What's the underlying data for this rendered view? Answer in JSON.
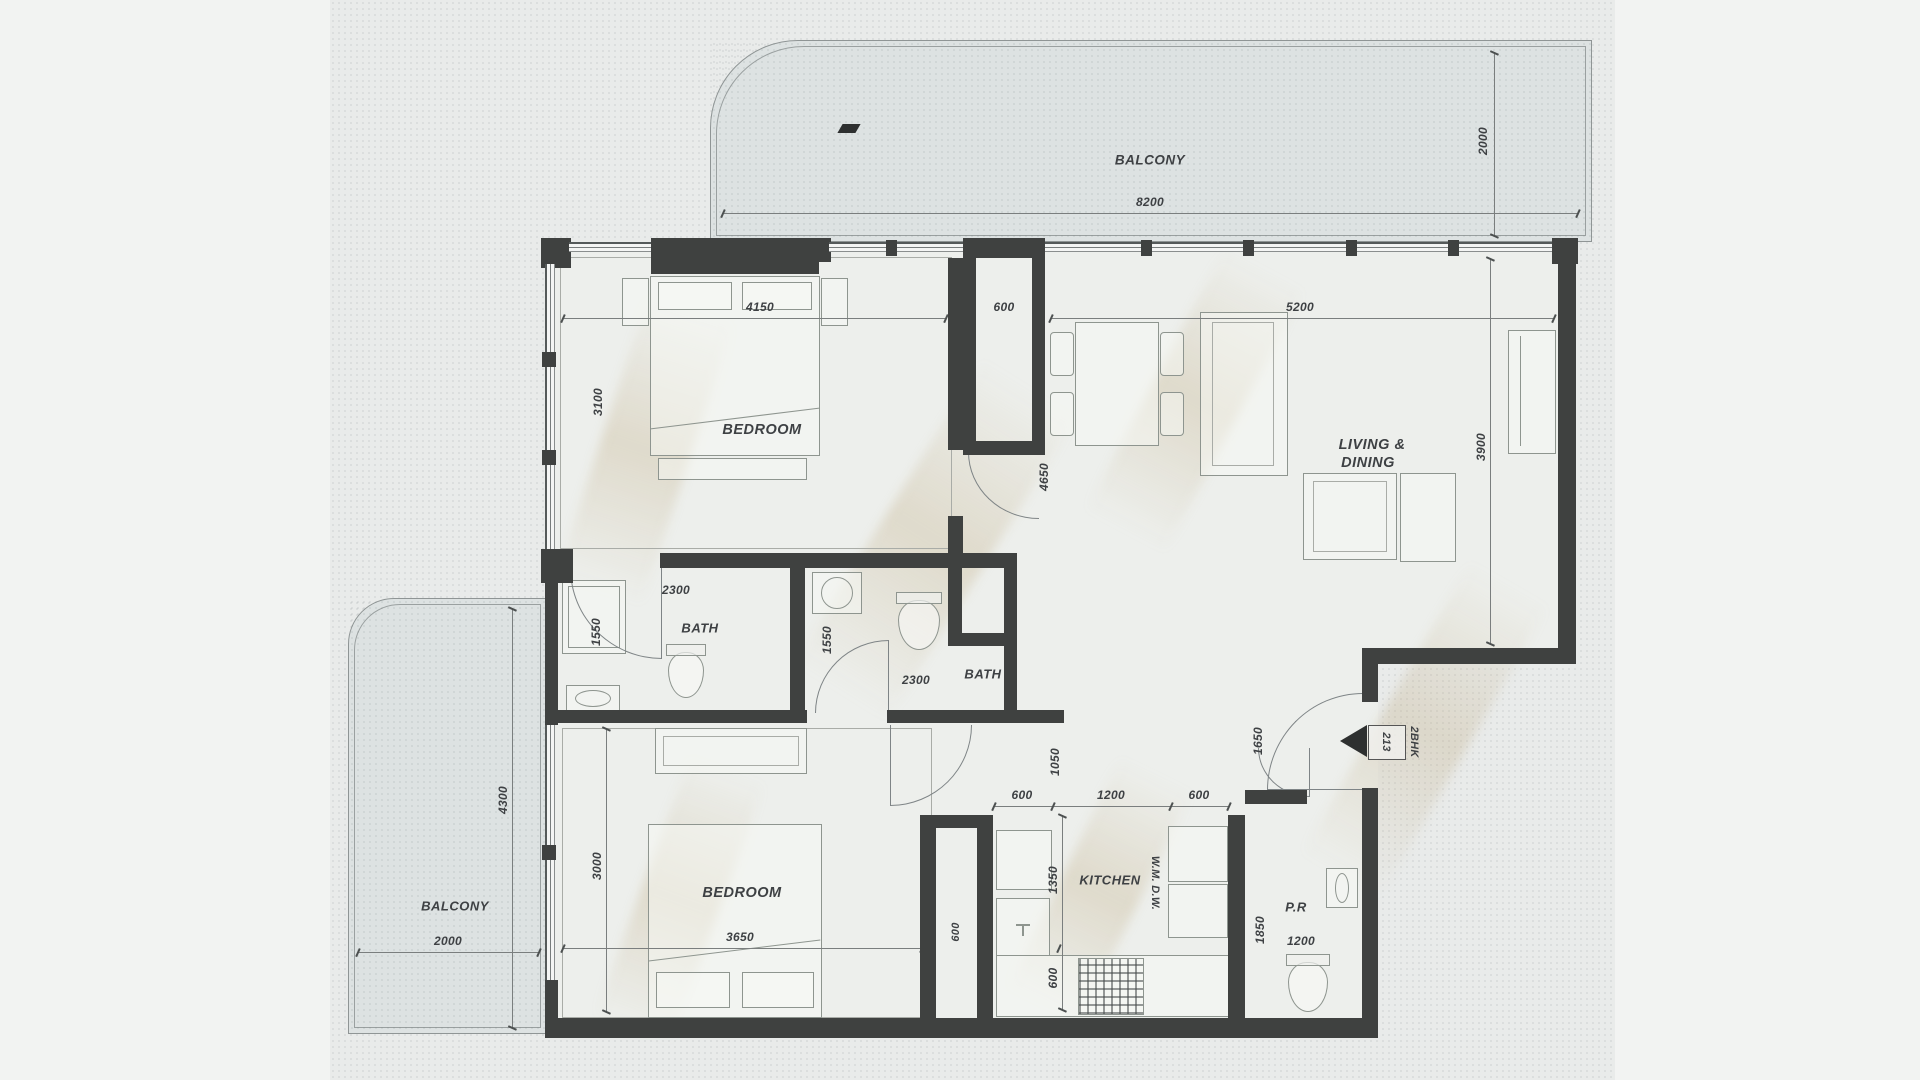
{
  "colors": {
    "wall": "#3f4140",
    "paper": "#e9ebea",
    "balcony_fill": "#dde2e2",
    "floor_fill": "#edefec",
    "text": "#3e4144"
  },
  "balcony_top": {
    "label": "BALCONY",
    "width_dim": "8200",
    "depth_dim": "2000"
  },
  "balcony_left": {
    "label": "BALCONY",
    "width_dim": "2000",
    "length_dim": "4300"
  },
  "bedroom_top": {
    "label": "BEDROOM",
    "width_dim": "4150",
    "depth_dim": "3100"
  },
  "living_dining": {
    "label_line1": "LIVING &",
    "label_line2": "DINING",
    "width_dim": "5200",
    "depth_dim": "3900",
    "dining_depth_dim": "4650"
  },
  "duct_top": {
    "dim": "600"
  },
  "bath_left": {
    "label": "BATH",
    "width_dim": "2300",
    "depth_dim": "1550"
  },
  "bath_middle": {
    "label": "BATH",
    "width_dim": "2300",
    "depth_dim": "1550"
  },
  "bedroom_bottom": {
    "label": "BEDROOM",
    "width_dim": "3650",
    "depth_dim": "3000"
  },
  "kitchen": {
    "label": "KITCHEN",
    "appliance_label": "W.M. D.W.",
    "counter_dim_left": "600",
    "counter_dim_mid": "1200",
    "counter_dim_right": "600",
    "depth_dim": "1350",
    "hob_dim": "600",
    "passage_dim": "1050"
  },
  "duct_bottom": {
    "dim": "600"
  },
  "powder_room": {
    "label": "P.R",
    "depth_dim": "1850",
    "width_dim": "1200"
  },
  "entry": {
    "door_dim": "1650",
    "unit_number": "213",
    "unit_type": "2BHK"
  }
}
